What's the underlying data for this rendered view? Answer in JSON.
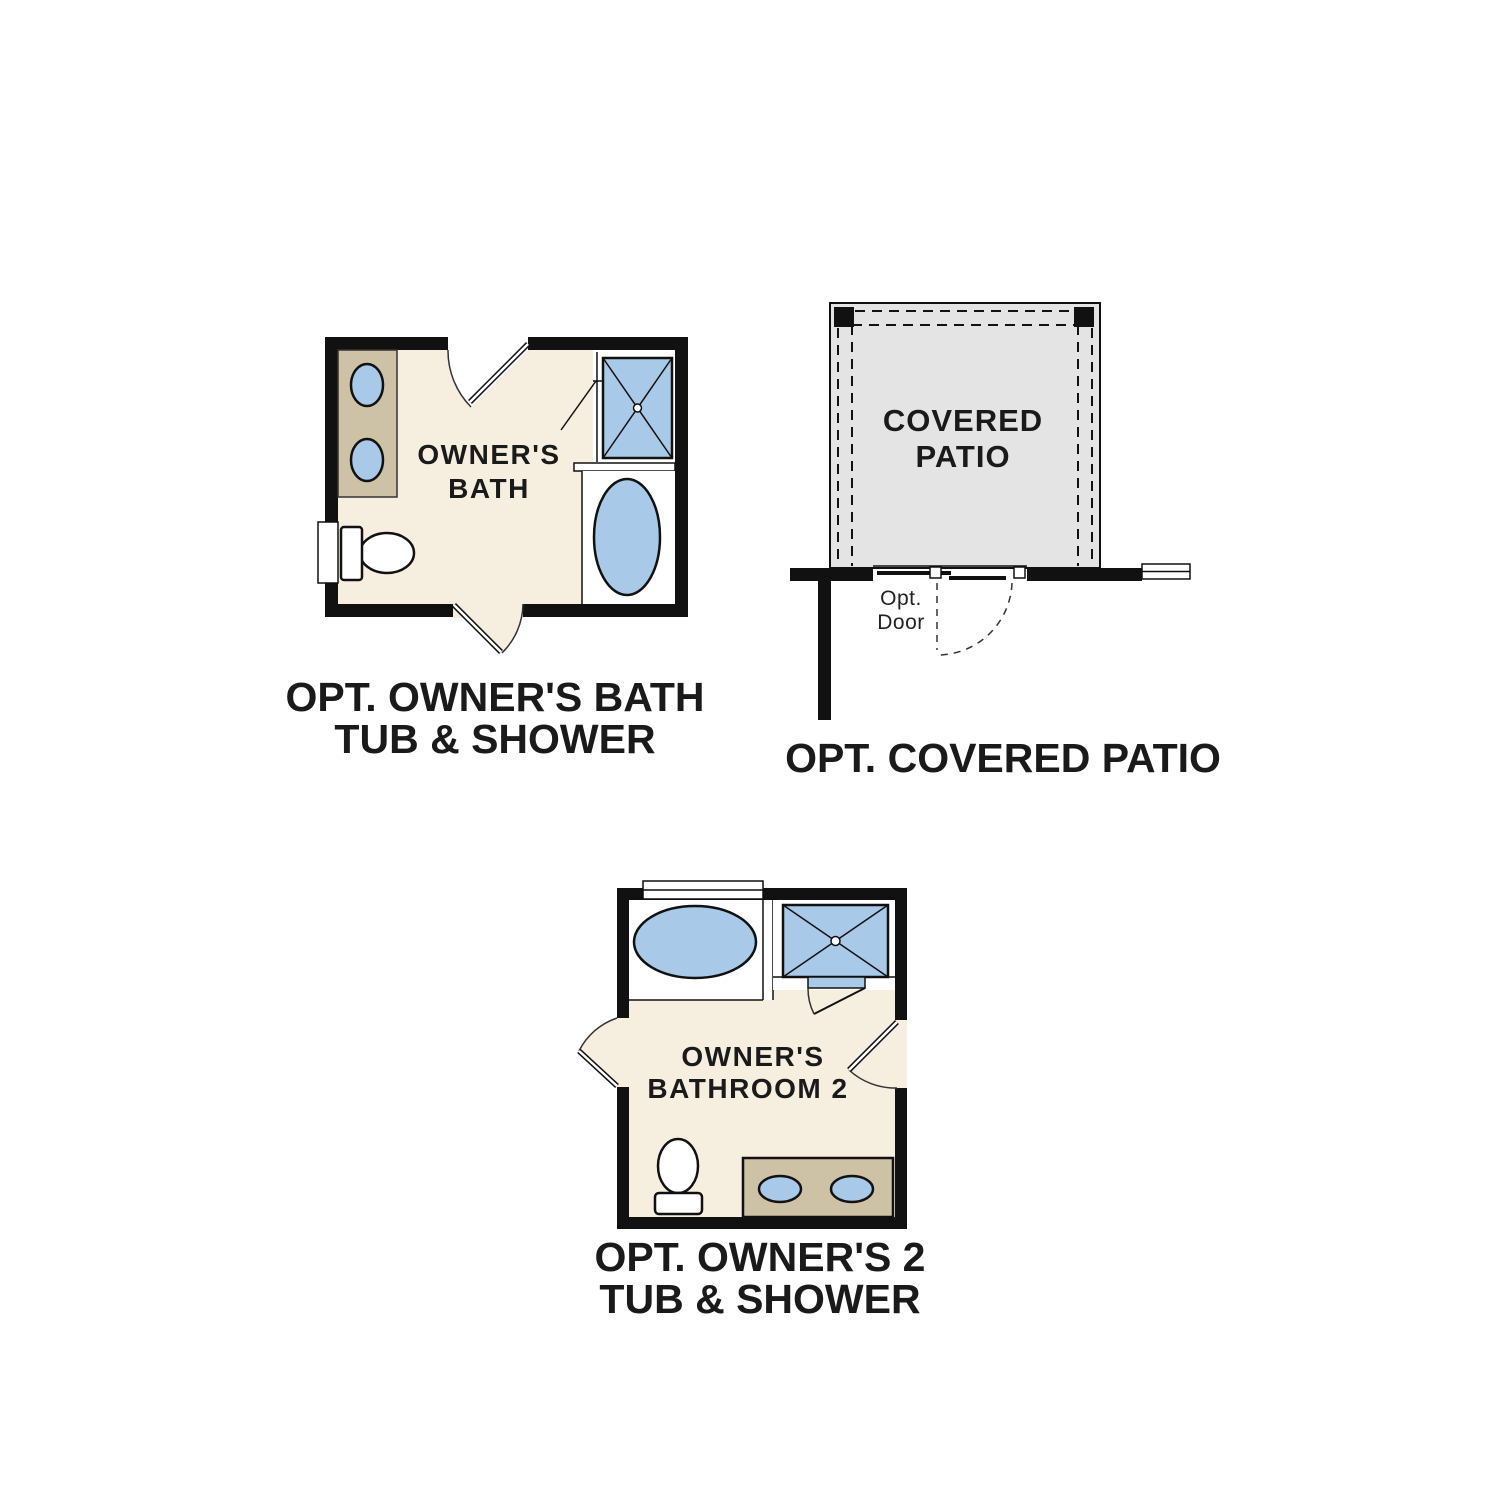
{
  "colors": {
    "wall": "#111111",
    "line": "#333333",
    "text": "#1a1a1a",
    "floor": "#f6efe0",
    "fixture_blue": "#a9c9e9",
    "vanity_tan": "#cdc1a6",
    "patio_gray": "#e4e4e4"
  },
  "plans": {
    "owners_bath": {
      "label_line1": "OWNER'S",
      "label_line2": "BATH",
      "caption_line1": "OPT. OWNER'S BATH",
      "caption_line2": "TUB & SHOWER"
    },
    "covered_patio": {
      "label_line1": "COVERED",
      "label_line2": "PATIO",
      "door_label_line1": "Opt.",
      "door_label_line2": "Door",
      "caption": "OPT. COVERED PATIO"
    },
    "owners_bathroom_2": {
      "label_line1": "OWNER'S",
      "label_line2": "BATHROOM 2",
      "caption_line1": "OPT. OWNER'S 2",
      "caption_line2": "TUB & SHOWER"
    }
  }
}
